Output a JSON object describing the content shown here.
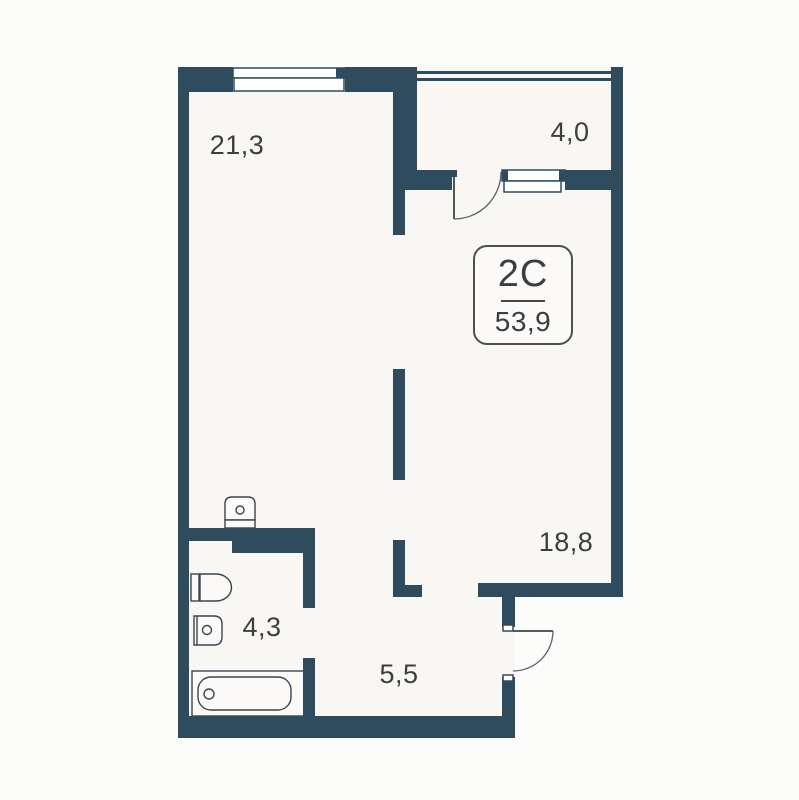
{
  "title": "Apartment floor plan",
  "badge": {
    "type": "2C",
    "area": "53,9"
  },
  "rooms": {
    "living_kitchen": {
      "area": "21,3"
    },
    "balcony": {
      "area": "4,0"
    },
    "bedroom": {
      "area": "18,8"
    },
    "bathroom": {
      "area": "4,3"
    },
    "hallway": {
      "area": "5,5"
    }
  },
  "fixtures": [
    "top-window",
    "balcony-window",
    "balcony-door",
    "entrance-door",
    "washing-machine",
    "toilet",
    "sink",
    "bathtub"
  ],
  "colors": {
    "wall": "#2e4c5d",
    "interior": "#f8f7f4",
    "background": "#fcfcfb",
    "text": "#3e3e3e"
  }
}
